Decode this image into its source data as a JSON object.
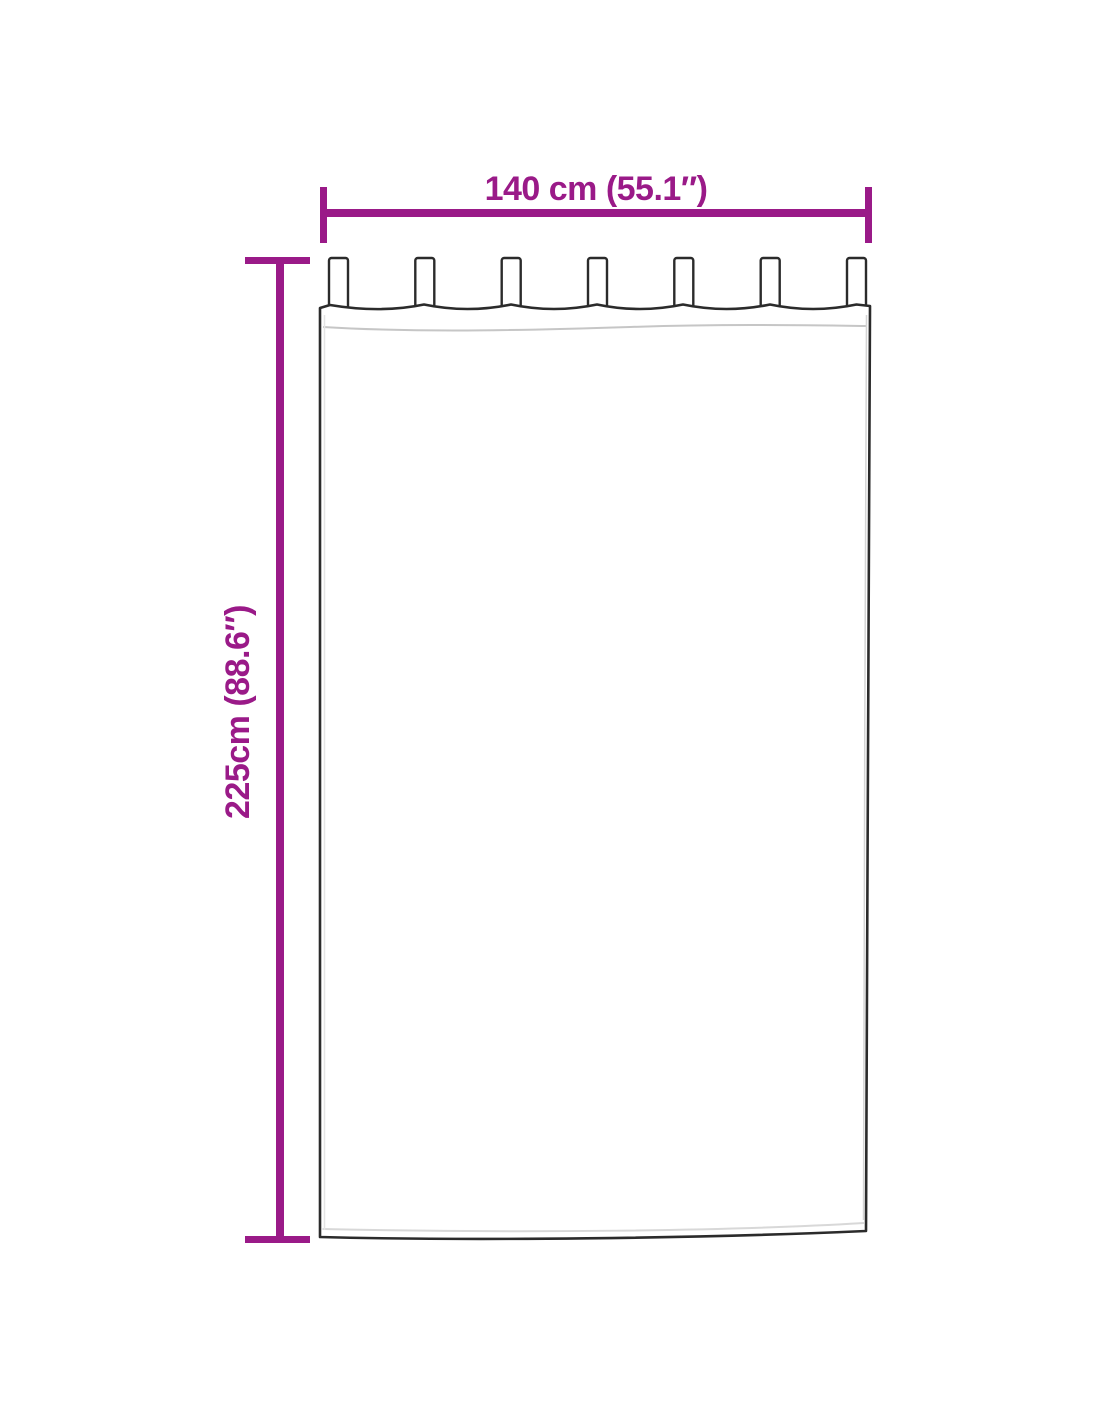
{
  "diagram": {
    "illustration": "tab-top curtain outline drawing",
    "curtain": {
      "tab_count": 7
    },
    "dimensions": {
      "width": {
        "label": "140 cm (55.1″)"
      },
      "height": {
        "label": "225cm (88.6″)"
      }
    },
    "colors": {
      "accent": "#9A1A88",
      "outline": "#2B2B2B"
    }
  }
}
